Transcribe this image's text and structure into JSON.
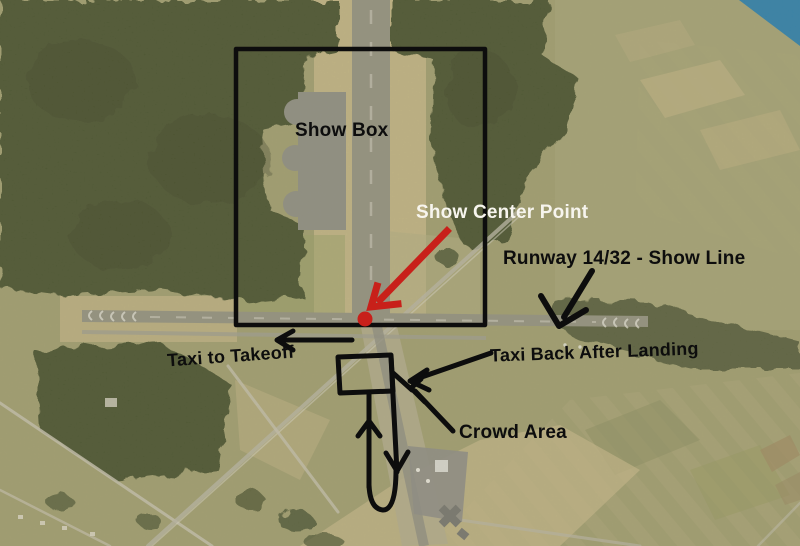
{
  "map": {
    "kind": "annotated aerial photo of airfield (airshow plan)",
    "labels": {
      "show_box": "Show Box",
      "show_center_point": "Show Center Point",
      "runway_show_line": "Runway 14/32 - Show Line",
      "taxi_to_takeoff": "Taxi to Takeoff",
      "taxi_back_after_landing": "Taxi Back After Landing",
      "crowd_area": "Crowd Area"
    },
    "markers": {
      "show_center_dot": "red circular dot at runway intersection",
      "show_box_outline": "black rectangle outline",
      "crowd_loop": "hand-drawn black taxi loop with arrows"
    }
  },
  "colors": {
    "annotation_black": "#0d0d0d",
    "annotation_red": "#c8201a",
    "label_white": "#f7f5ee",
    "water": "#2e80ab",
    "forest": "#49522f",
    "field": "#a19e6f",
    "runway_gray": "#94927f",
    "runway_tan": "#c4b685"
  }
}
